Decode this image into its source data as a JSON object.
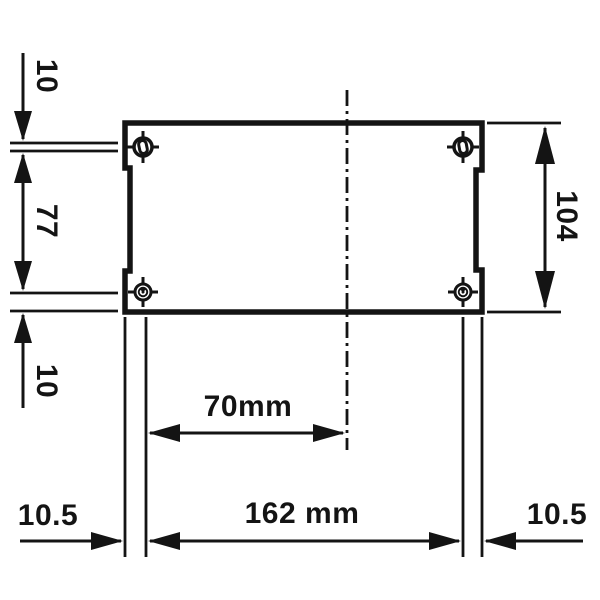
{
  "drawing": {
    "kind": "mounting-dimension-diagram",
    "colors": {
      "line": "#141414",
      "background": "#ffffff"
    },
    "labels": {
      "top_hole_offset": "10",
      "vertical_hole_pitch": "77",
      "bottom_hole_offset": "10",
      "housing_height": "104",
      "center_to_hole": "70mm",
      "left_edge_to_hole": "10.5",
      "horizontal_hole_pitch": "162 mm",
      "right_edge_to_hole": "10.5"
    },
    "icons": [
      "mounting-hole-top-left-icon",
      "mounting-hole-top-right-icon",
      "mounting-hole-bottom-left-icon",
      "mounting-hole-bottom-right-icon"
    ]
  }
}
